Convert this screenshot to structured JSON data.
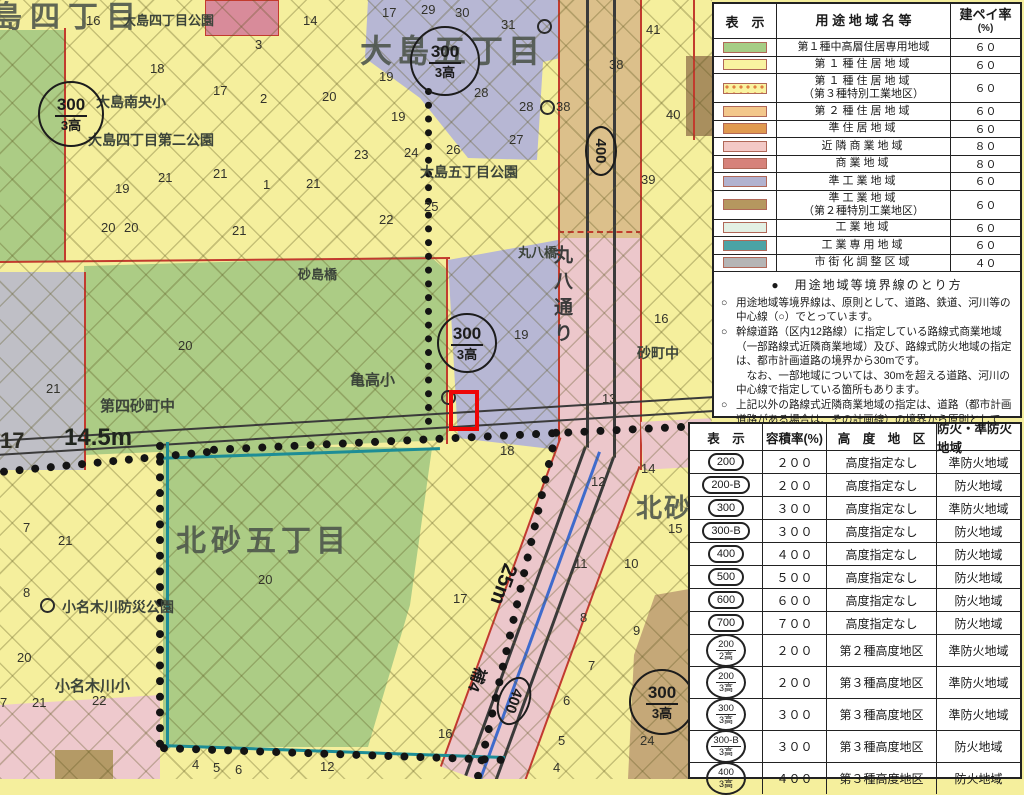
{
  "map": {
    "district_large": {
      "ojima4_partial": "島四丁目",
      "ojima5": "大島五丁目",
      "kitasuna5": "北砂五丁目",
      "kitasuna_partial": "北砂"
    },
    "places": {
      "ojima4_park": "大島四丁目公園",
      "ojima_nanou_sho": "大島南央小",
      "ojima4_park2": "大島四丁目第二公園",
      "ojima5_park": "大島五丁目公園",
      "sunajima_bridge": "砂島橋",
      "maruhachi_bridge": "丸八橋",
      "maruhachi_street": "丸八通り",
      "sunamachi_jhs": "砂町中",
      "daiyon_sunamachi_jhs": "第四砂町中",
      "kametaka_sho": "亀高小",
      "onagigawa_bosai_park": "小名木川防災公園",
      "onagigawa_sho": "小名木川小"
    },
    "road_labels": {
      "w145": "14.5m",
      "w25": "25m",
      "ho4": "補4"
    },
    "symbols": {
      "s300_top": "300",
      "s300_bottom": "3高",
      "s400": "400"
    },
    "numbers": [
      "16",
      "14",
      "3",
      "18",
      "17",
      "2",
      "20",
      "19",
      "21",
      "21",
      "1",
      "21",
      "20",
      "20",
      "21",
      "17",
      "29",
      "30",
      "31",
      "19",
      "19",
      "28",
      "28",
      "38",
      "27",
      "23",
      "24",
      "26",
      "25",
      "22",
      "41",
      "38",
      "40",
      "39",
      "20",
      "21",
      "19",
      "16",
      "13",
      "18",
      "17",
      "12",
      "14",
      "15",
      "10",
      "11",
      "8",
      "9",
      "7",
      "6",
      "5",
      "4",
      "16",
      "24",
      "7",
      "21",
      "8",
      "20",
      "20",
      "7",
      "21",
      "22",
      "4",
      "5",
      "6",
      "12",
      "17"
    ]
  },
  "legend_use": {
    "headers": {
      "col1": "表　示",
      "col2": "用 途 地 域 名 等",
      "col3a": "建ペイ率",
      "col3b": "(%)"
    },
    "rows": [
      {
        "name": "第１種中高層住居専用地域",
        "sub": "",
        "ratio": "６０",
        "color": "#a6cd85"
      },
      {
        "name": "第１種住居地域",
        "sub": "",
        "ratio": "６０",
        "color": "#f9f3a0"
      },
      {
        "name": "第１種住居地域",
        "sub": "（第３種特別工業地区）",
        "ratio": "６０",
        "color": "#f9f3a0",
        "pattern": "dots"
      },
      {
        "name": "第２種住居地域",
        "sub": "",
        "ratio": "６０",
        "color": "#f3c78b"
      },
      {
        "name": "準住居地域",
        "sub": "",
        "ratio": "６０",
        "color": "#e09a50"
      },
      {
        "name": "近隣商業地域",
        "sub": "",
        "ratio": "８０",
        "color": "#f3c9c6"
      },
      {
        "name": "商業地域",
        "sub": "",
        "ratio": "８０",
        "color": "#d6827a"
      },
      {
        "name": "準工業地域",
        "sub": "",
        "ratio": "６０",
        "color": "#b2b2cf"
      },
      {
        "name": "準工業地域",
        "sub": "（第２種特別工業地区）",
        "ratio": "６０",
        "color": "#b5975f"
      },
      {
        "name": "工業地域",
        "sub": "",
        "ratio": "６０",
        "color": "#e3f0e4"
      },
      {
        "name": "工業専用地域",
        "sub": "",
        "ratio": "６０",
        "color": "#4ba3a5"
      },
      {
        "name": "市街化調整区域",
        "sub": "",
        "ratio": "４０",
        "color": "#b5b5b5"
      }
    ],
    "notes": {
      "title": "●　用途地域等境界線のとり方",
      "items": [
        {
          "b": "○",
          "t": "用途地域等境界線は、原則として、道路、鉄道、河川等の中心線（○）でとっています。"
        },
        {
          "b": "○",
          "t": "幹線道路（区内12路線）に指定している路線式商業地域（一部路線式近隣商業地域）及び、路線式防火地域の指定は、都市計画道路の境界から30mです。"
        },
        {
          "b": "",
          "t": "　なお、一部地域については、30mを超える道路、河川の中心線で指定している箇所もあります。"
        },
        {
          "b": "○",
          "t": "上記以外の路線式近隣商業地域の指定は、道路（都市計画道路がある場合は、その計画線）の境界から原則として20mです。"
        }
      ]
    }
  },
  "legend_ratio": {
    "headers": [
      "表　示",
      "容積率(%)",
      "高　度　地　区",
      "防火・準防火地域"
    ],
    "rows": [
      {
        "sym": "200",
        "symtype": "oval",
        "ratio": "２００",
        "height": "高度指定なし",
        "fire": "準防火地域"
      },
      {
        "sym": "200-B",
        "symtype": "oval",
        "ratio": "２００",
        "height": "高度指定なし",
        "fire": "防火地域"
      },
      {
        "sym": "300",
        "symtype": "oval",
        "ratio": "３００",
        "height": "高度指定なし",
        "fire": "準防火地域"
      },
      {
        "sym": "300-B",
        "symtype": "oval",
        "ratio": "３００",
        "height": "高度指定なし",
        "fire": "防火地域"
      },
      {
        "sym": "400",
        "symtype": "oval",
        "ratio": "４００",
        "height": "高度指定なし",
        "fire": "防火地域"
      },
      {
        "sym": "500",
        "symtype": "oval",
        "ratio": "５００",
        "height": "高度指定なし",
        "fire": "防火地域"
      },
      {
        "sym": "600",
        "symtype": "oval",
        "ratio": "６００",
        "height": "高度指定なし",
        "fire": "防火地域"
      },
      {
        "sym": "700",
        "symtype": "oval",
        "ratio": "７００",
        "height": "高度指定なし",
        "fire": "防火地域"
      },
      {
        "symtop": "200",
        "symbot": "2高",
        "symtype": "frac",
        "ratio": "２００",
        "height": "第２種高度地区",
        "fire": "準防火地域"
      },
      {
        "symtop": "200",
        "symbot": "3高",
        "symtype": "frac",
        "ratio": "２００",
        "height": "第３種高度地区",
        "fire": "準防火地域"
      },
      {
        "symtop": "300",
        "symbot": "3高",
        "symtype": "frac",
        "ratio": "３００",
        "height": "第３種高度地区",
        "fire": "準防火地域"
      },
      {
        "symtop": "300-B",
        "symbot": "3高",
        "symtype": "frac",
        "ratio": "３００",
        "height": "第３種高度地区",
        "fire": "防火地域"
      },
      {
        "symtop": "400",
        "symbot": "3高",
        "symtype": "frac",
        "ratio": "４００",
        "height": "第３種高度地区",
        "fire": "防火地域"
      }
    ]
  }
}
